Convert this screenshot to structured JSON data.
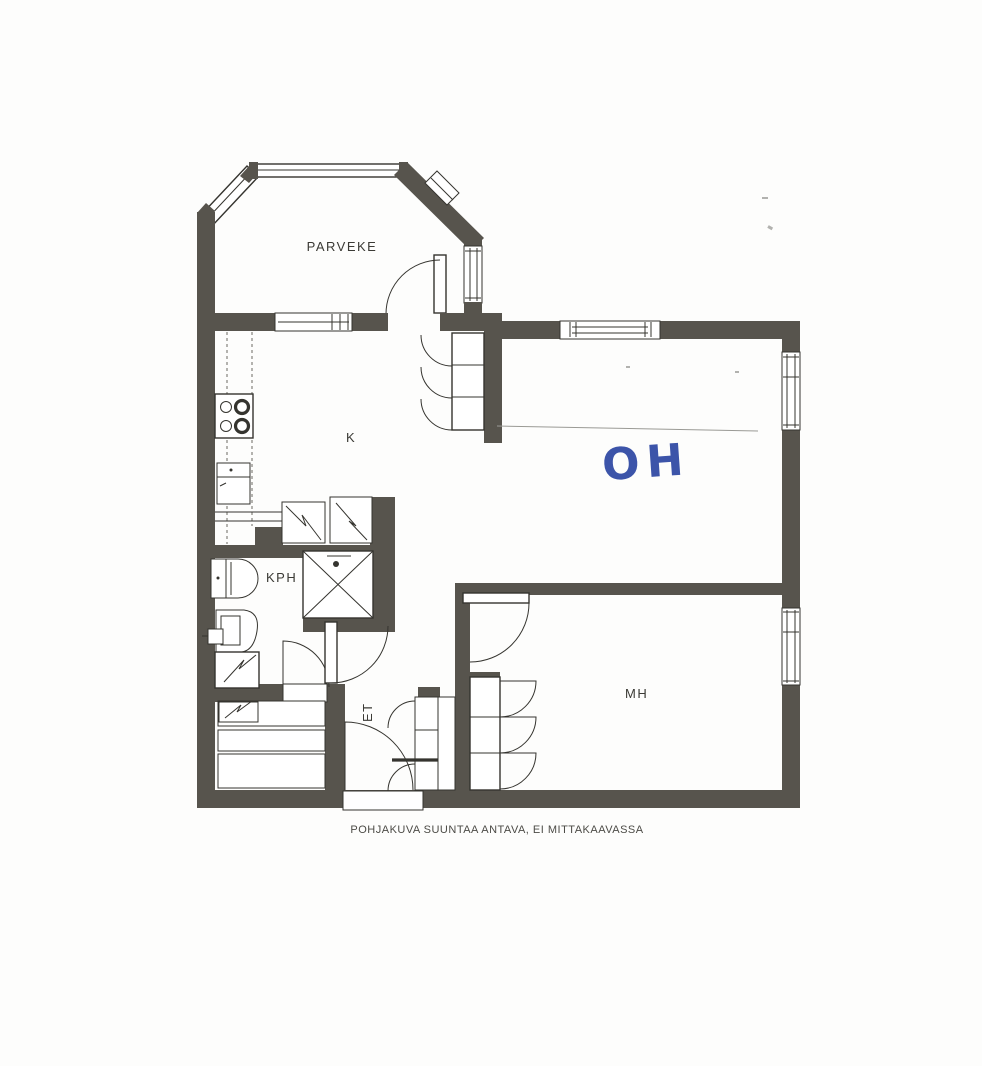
{
  "document": {
    "caption": "POHJAKUVA SUUNTAA ANTAVA, EI MITTAKAAVASSA"
  },
  "rooms": {
    "balcony": {
      "label": "PARVEKE"
    },
    "kitchen": {
      "label": "K"
    },
    "living_room": {
      "label": "OH",
      "note": "handwritten in blue ink"
    },
    "bathroom": {
      "label": "KPH"
    },
    "hallway": {
      "label": "ET"
    },
    "bedroom": {
      "label": "MH"
    }
  },
  "colors": {
    "wall": "#57544d",
    "line": "#35342f",
    "paper": "#fdfdfc",
    "ink_blue": "#3c54a9",
    "label": "#3b3a35",
    "caption": "#4c4b46",
    "fold_line": "#9a9a95"
  }
}
